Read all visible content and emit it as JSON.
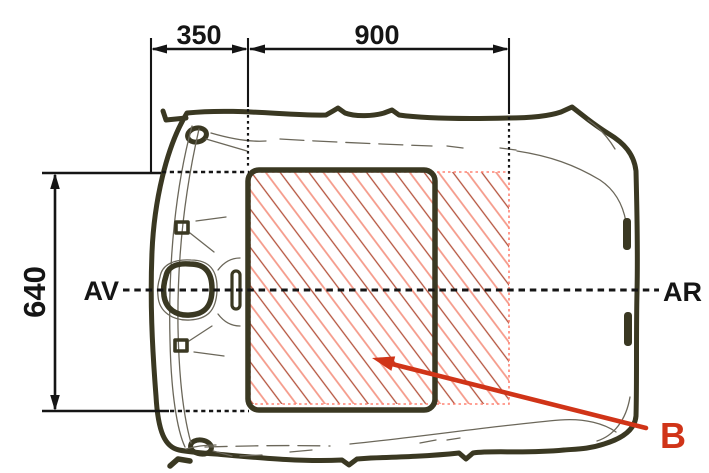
{
  "diagram": {
    "type": "technical-drawing",
    "subject": "car-roof-top-view-sunroof-installation-zone",
    "dimensions": {
      "front_offset": "350",
      "zone_length": "900",
      "zone_width": "640"
    },
    "labels": {
      "front": "AV",
      "rear": "AR",
      "zone": "B"
    },
    "colors": {
      "bg": "#ffffff",
      "outline": "#3a3822",
      "sketch": "#6b675a",
      "dim": "#151515",
      "accent": "#d03418",
      "hatch-dark": "#b4523c",
      "hatch-light": "#f59a8a",
      "zone-border": "#ff8272"
    }
  }
}
